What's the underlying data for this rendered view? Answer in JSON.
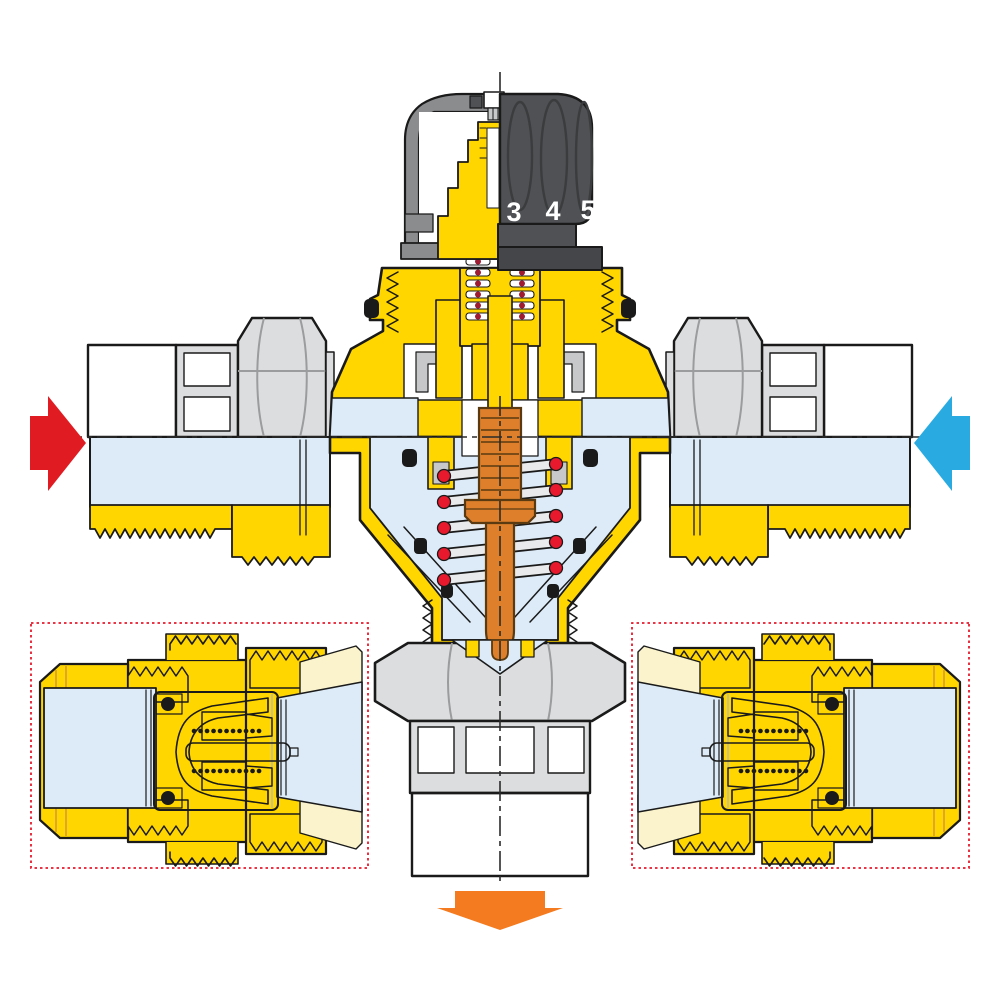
{
  "diagram": {
    "title": "thermostatic-mixing-valve-cutaway",
    "knob": {
      "scale_numbers": [
        "3",
        "4",
        "5"
      ]
    },
    "flows": {
      "left_arrow": "right",
      "right_arrow": "left",
      "bottom_arrow": "down"
    },
    "insets": {
      "count": 2,
      "content": "check-valve-cartridge-cutaway"
    }
  },
  "colors": {
    "bg": "#FFFFFF",
    "ink": "#1A1A1A",
    "centerline": "#2B2B2B",
    "brass": "#FFD600",
    "brass-shade": "#E0A62B",
    "water": "#DCEBF7",
    "steel": "#DCDDDE",
    "steel-dark": "#9A9C9E",
    "gray-part": "#C7C8CA",
    "thread-line": "#707174",
    "knob": "#4F5154",
    "knob-dark": "#44464A",
    "shell": "#8A8C8E",
    "thermo": "#DD7F2B",
    "thermo-dark": "#5A3A10",
    "spring-bar": "#E9EAEB",
    "spring-dot": "#E8192C",
    "coil-dot": "#9E1B32",
    "hot": "#E11B22",
    "cold": "#29ABE2",
    "mix": "#F47B20",
    "inset-border": "#E8192C",
    "cream": "#FAF3CC"
  }
}
